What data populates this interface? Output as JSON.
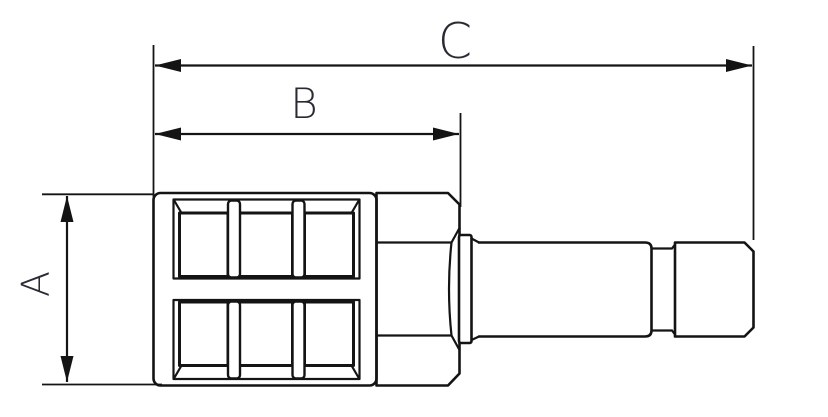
{
  "colors": {
    "line": "#141414",
    "label_text": "#2a2a34",
    "background": "#ffffff"
  },
  "dimensions": {
    "a": {
      "label": "A"
    },
    "b": {
      "label": "B"
    },
    "c": {
      "label": "C"
    }
  }
}
